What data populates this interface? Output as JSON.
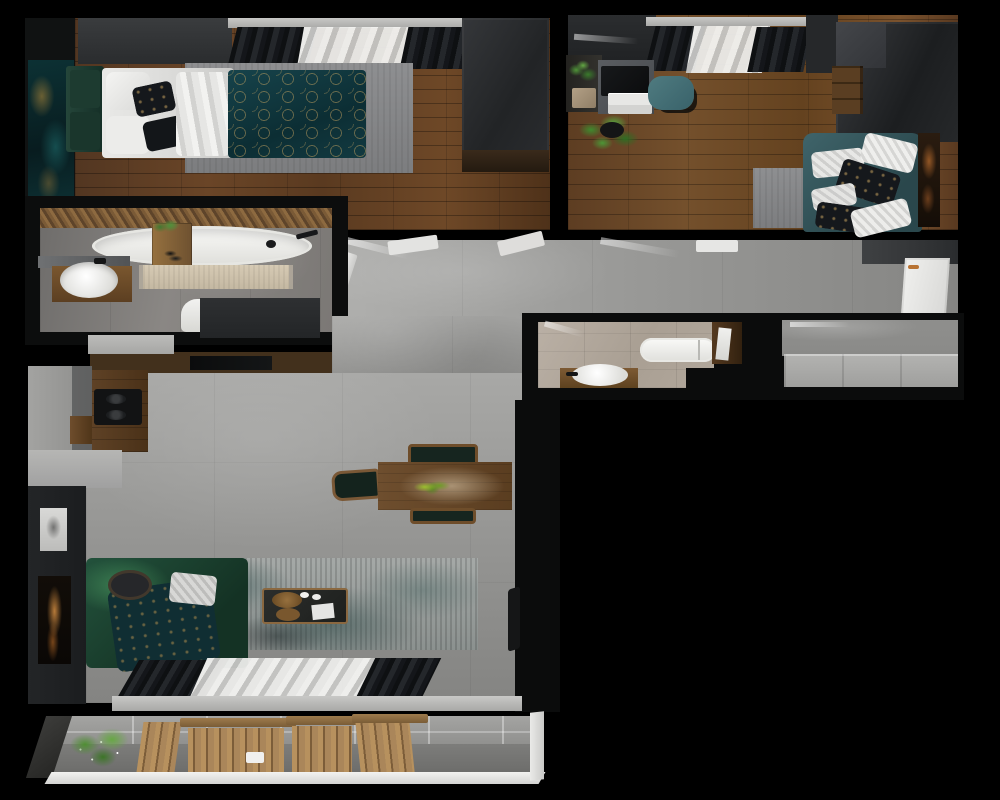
{
  "scene": {
    "type": "3d-floor-plan-top-view",
    "label": "Apartment floor plan - photorealistic 3D top-down render, L-shaped unit on black background",
    "rooms": {
      "bedroom": {
        "label": "Bedroom",
        "items": [
          "green upholstered headboard bench",
          "bed with white linens",
          "teal patterned duvet with gold rings",
          "dark accent pillows",
          "gray area rug",
          "dark wardrobe",
          "window with black curtains and white sheer",
          "teal abstract wall art",
          "dark wood plank floor"
        ]
      },
      "office": {
        "label": "Office / second room",
        "items": [
          "gray desk with black laptop",
          "white drawer unit",
          "teal desk chair",
          "wall plant shelf",
          "potted floor plant",
          "dark wardrobe",
          "wood drawer chest",
          "teal sofa with patterned pillows",
          "gray rug",
          "copper abstract wall art",
          "window with black curtains and white sheer",
          "wood plank floor"
        ]
      },
      "bathroom_main": {
        "label": "Main bathroom",
        "items": [
          "freestanding white oval bathtub",
          "wood bath caddy with plant",
          "diagonal wood slat accent wall",
          "beige runner rug",
          "round vessel sink on wood vanity with mirror",
          "white toilet",
          "gray cabinet front",
          "gray stone tile floor"
        ]
      },
      "hallway": {
        "label": "Hallway / entry",
        "items": [
          "concrete tile floor",
          "open white doors at room thresholds",
          "white entry door with copper handle"
        ]
      },
      "bathroom_2": {
        "label": "Second bathroom",
        "items": [
          "white compact bathtub",
          "round sink on wood bench",
          "dark wood tall cabinet",
          "beige wood-look tile floor"
        ]
      },
      "storage": {
        "label": "Storage / wardrobe room",
        "items": [
          "light gray built-in cabinets",
          "concrete wall",
          "concrete floor"
        ]
      },
      "living": {
        "label": "Living room + kitchen",
        "items": [
          "L-shaped kitchen with wood counter and black cooktop",
          "dark wood media wall with TV",
          "wood dining table with plant and dark chairs",
          "green sofa with teal patterned throw",
          "black floor lamp",
          "dark coffee table with wood trays",
          "distressed gray-teal rug",
          "white and black framed wall art",
          "window wall with black curtains and white sheer",
          "concrete floor"
        ]
      },
      "balcony": {
        "label": "Balcony",
        "items": [
          "concrete block wall",
          "green plants with white flowers",
          "folding wood slat furniture set",
          "gray floor",
          "white railing"
        ]
      }
    },
    "palette": {
      "background": "#000000",
      "wall_dark": "#1d1f21",
      "wood_floor": "#64421f",
      "concrete_floor": "#9c9c9a",
      "teal_textile": "#14383e",
      "green_sofa": "#1d4a36",
      "teal_sofa": "#34575c",
      "gold_accent": "#c9a460",
      "white_fixture": "#efefed",
      "copper_handle": "#b87333",
      "balcony_wood": "#b7915e"
    }
  }
}
